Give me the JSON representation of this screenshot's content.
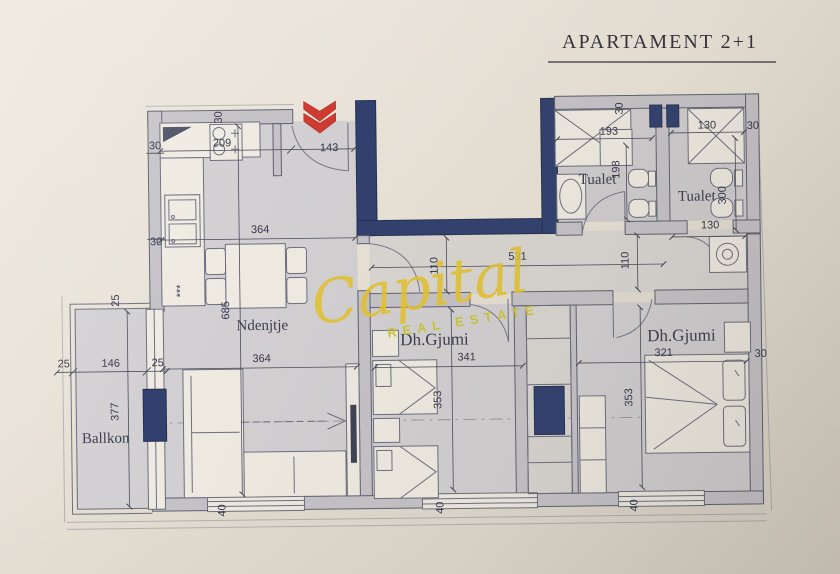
{
  "title": "APARTAMENT 2+1",
  "watermark": {
    "brand": "Capital",
    "tagline": "REAL ESTATE"
  },
  "rooms": {
    "living": "Ndenjtje",
    "bedroom1": "Dh.Gjumi",
    "bedroom2": "Dh.Gjumi",
    "bathroom1": "Tualet",
    "bathroom2": "Tualet",
    "balcony": "Ballkon"
  },
  "symbols": {
    "kitchen_stars": "***"
  },
  "dims": {
    "kitchen_width": "209",
    "entry_wall": "30",
    "entry_door": "143",
    "left_wall_upper": "30",
    "left_wall_lower": "30",
    "living_width_top": "364",
    "living_length": "685",
    "living_width_mid": "364",
    "balcony_wall_left": "25",
    "balcony_width": "146",
    "balcony_wall_right": "25",
    "balcony_wall_top": "25",
    "balcony_length": "377",
    "sill_living": "40",
    "sill_bedroom1": "40",
    "sill_bedroom2": "40",
    "hall_length": "531",
    "hall_width_left": "110",
    "hall_width_right": "110",
    "bedroom1_width": "341",
    "bedroom1_length": "353",
    "bedroom2_width": "321",
    "bedroom2_length": "353",
    "bedroom2_wall": "30",
    "bath1_width": "193",
    "bath1_wall": "30",
    "bath1_length": "198",
    "bath2_width_top": "130",
    "bath2_wall": "30",
    "bath2_length": "300",
    "bath2_width_bottom": "130"
  }
}
